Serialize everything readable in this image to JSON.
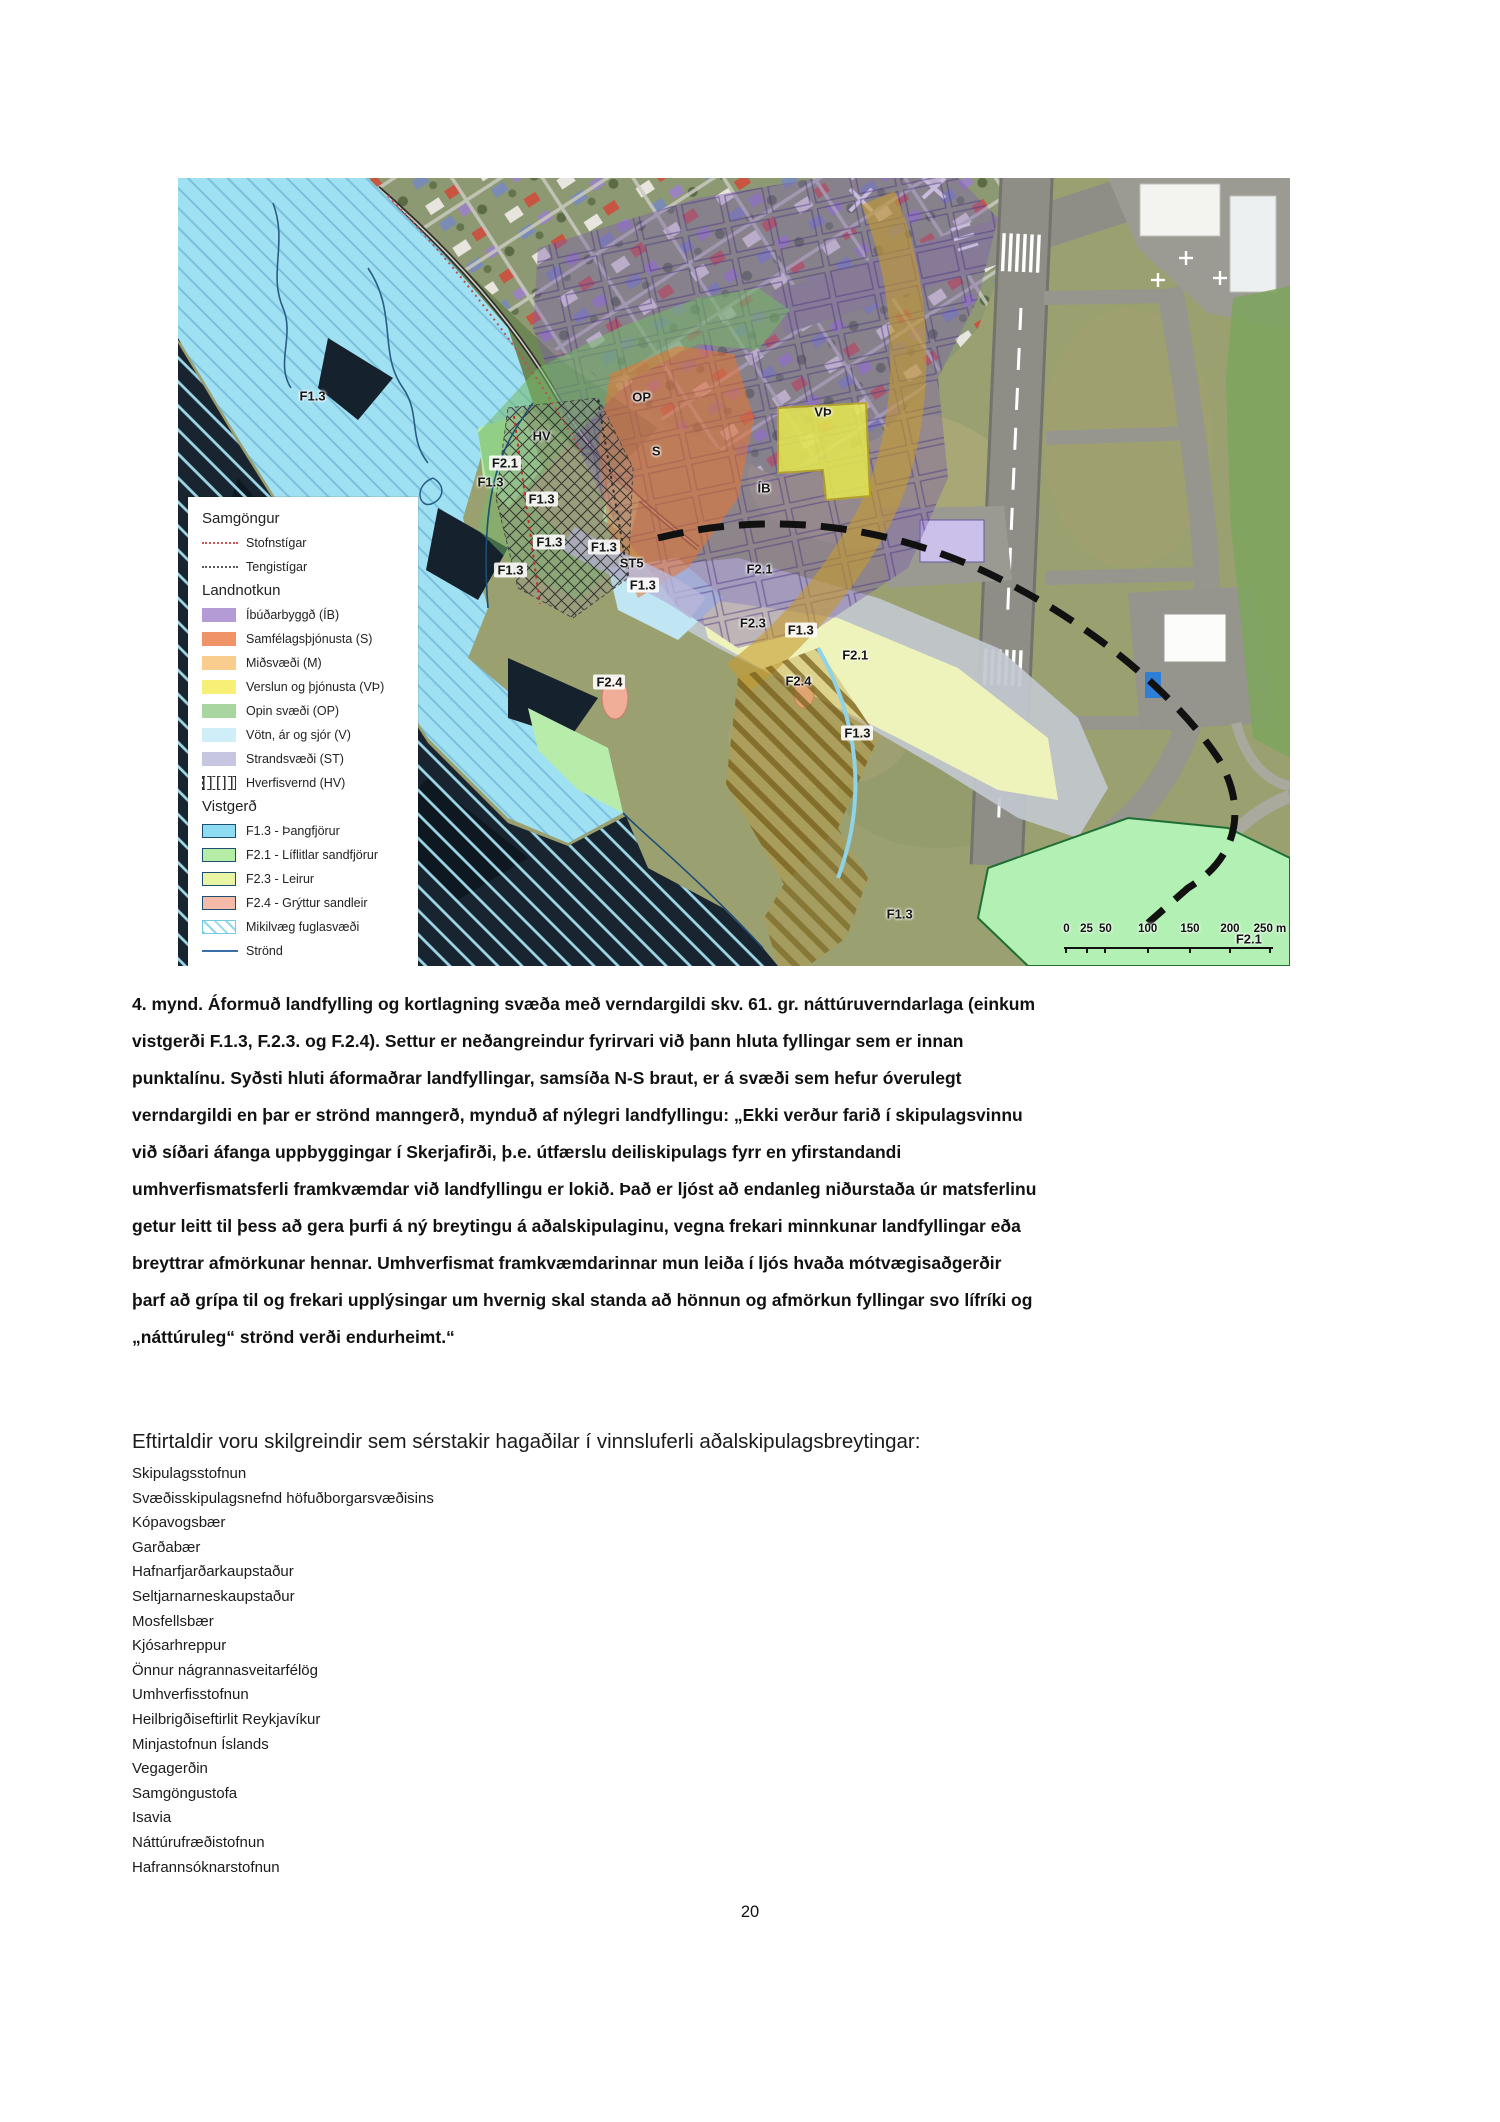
{
  "page": {
    "number": "20"
  },
  "map": {
    "legend": {
      "samgongur": {
        "title": "Samgöngur",
        "items": [
          {
            "label": "Stofnstígar"
          },
          {
            "label": "Tengistígar"
          }
        ]
      },
      "landnotkun": {
        "title": "Landnotkun",
        "items": [
          {
            "label": "Íbúðarbyggð (ÍB)",
            "color": "#b49bd6"
          },
          {
            "label": "Samfélagsþjónusta (S)",
            "color": "#ef9468"
          },
          {
            "label": "Miðsvæði (M)",
            "color": "#f8cd8e"
          },
          {
            "label": "Verslun og þjónusta (VÞ)",
            "color": "#f6f176"
          },
          {
            "label": "Opin svæði (OP)",
            "color": "#a9d6a0"
          },
          {
            "label": "Vötn, ár og sjór (V)",
            "color": "#cfeef8"
          },
          {
            "label": "Strandsvæði (ST)",
            "color": "#c6c6e1"
          },
          {
            "label": "Hverfisvernd (HV)",
            "color": "hatch"
          }
        ]
      },
      "vistgerd": {
        "title": "Vistgerð",
        "items": [
          {
            "label": "F1.3 - Þangfjörur",
            "color": "#8edcf2"
          },
          {
            "label": "F2.1 - Líflitlar sandfjörur",
            "color": "#b5eda6"
          },
          {
            "label": "F2.3 - Leirur",
            "color": "#eaf4a5"
          },
          {
            "label": "F2.4 - Grýttur sandleir",
            "color": "#f6baa8"
          },
          {
            "label": "Mikilvæg fuglasvæði",
            "color": "birdhatch"
          },
          {
            "label": "Strönd",
            "color": "line"
          }
        ]
      }
    },
    "area_labels": [
      {
        "text": "F1.3",
        "x": 12.1,
        "y": 27.7
      },
      {
        "text": "F1.3",
        "x": 28.1,
        "y": 38.6
      },
      {
        "text": "F1.3",
        "x": 32.7,
        "y": 40.7,
        "chip": true
      },
      {
        "text": "F1.3",
        "x": 33.4,
        "y": 46.2,
        "chip": true
      },
      {
        "text": "F1.3",
        "x": 38.3,
        "y": 46.8,
        "chip": true
      },
      {
        "text": "F1.3",
        "x": 29.9,
        "y": 49.7,
        "chip": true
      },
      {
        "text": "F1.3",
        "x": 41.8,
        "y": 51.7,
        "chip": true
      },
      {
        "text": "F1.3",
        "x": 56.0,
        "y": 57.3,
        "chip": true
      },
      {
        "text": "F1.3",
        "x": 61.1,
        "y": 70.4,
        "chip": true
      },
      {
        "text": "F1.3",
        "x": 64.9,
        "y": 93.4
      },
      {
        "text": "F2.1",
        "x": 29.4,
        "y": 36.2,
        "chip": true
      },
      {
        "text": "F2.1",
        "x": 52.3,
        "y": 49.6
      },
      {
        "text": "F2.1",
        "x": 60.9,
        "y": 60.5
      },
      {
        "text": "F2.1",
        "x": 96.3,
        "y": 96.6
      },
      {
        "text": "F2.3",
        "x": 51.7,
        "y": 56.5
      },
      {
        "text": "F2.4",
        "x": 38.8,
        "y": 64.0,
        "chip": true
      },
      {
        "text": "F2.4",
        "x": 55.8,
        "y": 63.8
      },
      {
        "text": "OP",
        "x": 41.7,
        "y": 27.8
      },
      {
        "text": "S",
        "x": 43.0,
        "y": 34.7
      },
      {
        "text": "VÞ",
        "x": 58.0,
        "y": 29.7
      },
      {
        "text": "ÍB",
        "x": 52.7,
        "y": 39.4
      },
      {
        "text": "HV",
        "x": 32.7,
        "y": 32.8
      },
      {
        "text": "ST5",
        "x": 40.8,
        "y": 48.8
      }
    ],
    "scalebar": {
      "ticks": [
        {
          "t": "0",
          "x": 79.9
        },
        {
          "t": "25",
          "x": 81.7
        },
        {
          "t": "50",
          "x": 83.4
        },
        {
          "t": "100",
          "x": 87.2
        },
        {
          "t": "150",
          "x": 91.0
        },
        {
          "t": "200",
          "x": 94.6
        },
        {
          "t": "250 m",
          "x": 98.2
        }
      ]
    },
    "colors": {
      "ocean": "#18242f",
      "ocean_stripe": "#9ed7e8",
      "foreshore_f13": "#9fe0f2",
      "overlay_ib": "#7d5fae",
      "overlay_s": "#e87430",
      "overlay_op": "#74b868",
      "overlay_vth": "#e6e94e",
      "overlay_gold": "#c79b2f",
      "overlay_st": "#b8b6da",
      "boundary_dash": "#111111"
    }
  },
  "caption": {
    "lines": [
      "4. mynd. Áformuð landfylling og kortlagning svæða með verndargildi skv. 61. gr. náttúruverndarlaga (einkum",
      "vistgerði F.1.3, F.2.3. og F.2.4). Settur er neðangreindur fyrirvari við þann hluta fyllingar sem er innan",
      "punktalínu. Syðsti hluti áformaðrar landfyllingar, samsíða N-S braut, er á svæði sem hefur óverulegt",
      "verndargildi en þar er strönd manngerð, mynduð af nýlegri landfyllingu: „Ekki verður farið í skipulagsvinnu",
      "við síðari áfanga uppbyggingar í Skerjafirði, þ.e. útfærslu deiliskipulags fyrr en yfirstandandi",
      "umhverfismatsferli framkvæmdar við landfyllingu er lokið. Það er ljóst að endanleg niðurstaða úr matsferlinu",
      "getur leitt til þess að gera þurfi á ný breytingu á aðalskipulaginu, vegna frekari minnkunar landfyllingar eða",
      "breyttrar afmörkunar hennar. Umhverfismat framkvæmdarinnar mun leiða í ljós hvaða mótvægisaðgerðir",
      "þarf að grípa til og frekari upplýsingar um hvernig skal standa að hönnun og afmörkun fyllingar svo lífríki og",
      "„náttúruleg“ strönd verði endurheimt.“"
    ]
  },
  "stakeholders": {
    "heading": "Eftirtaldir voru skilgreindir sem sérstakir hagaðilar í vinnsluferli aðalskipulagsbreytingar:",
    "items": [
      "Skipulagsstofnun",
      "Svæðisskipulagsnefnd höfuðborgarsvæðisins",
      "Kópavogsbær",
      "Garðabær",
      "Hafnarfjarðarkaupstaður",
      "Seltjarnarneskaupstaður",
      "Mosfellsbær",
      "Kjósarhreppur",
      "Önnur nágrannasveitarfélög",
      "Umhverfisstofnun",
      "Heilbrigðiseftirlit Reykjavíkur",
      "Minjastofnun Íslands",
      "Vegagerðin",
      "Samgöngustofa",
      "Isavia",
      "Náttúrufræðistofnun",
      "Hafrannsóknarstofnun"
    ]
  }
}
